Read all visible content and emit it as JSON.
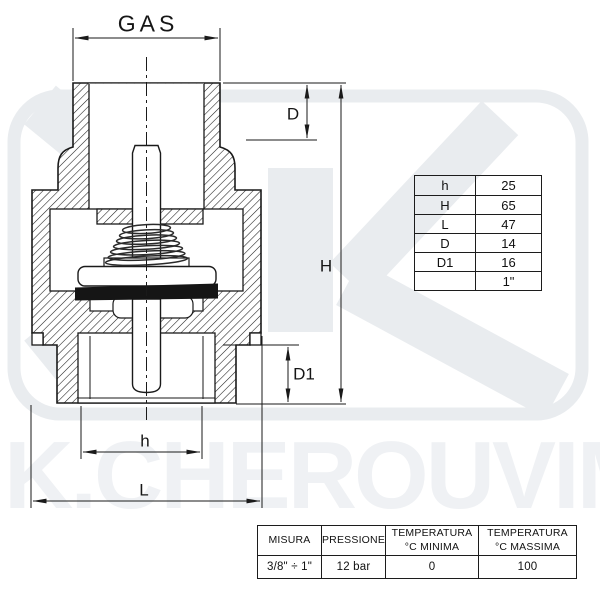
{
  "watermark": {
    "text": "K.CHEROUVIM"
  },
  "drawing": {
    "labels": {
      "gas": "GAS",
      "d": "D",
      "h_total": "H",
      "d1": "D1",
      "h_inner": "h",
      "l": "L"
    }
  },
  "dim_table": {
    "rows": [
      {
        "label": "h",
        "value": "25"
      },
      {
        "label": "H",
        "value": "65"
      },
      {
        "label": "L",
        "value": "47"
      },
      {
        "label": "D",
        "value": "14"
      },
      {
        "label": "D1",
        "value": "16"
      },
      {
        "label": "",
        "value": "1\""
      }
    ]
  },
  "spec_table": {
    "headers": [
      {
        "line1": "MISURA",
        "line2": ""
      },
      {
        "line1": "PRESSIONE",
        "line2": ""
      },
      {
        "line1": "TEMPERATURA",
        "line2": "°C MINIMA"
      },
      {
        "line1": "TEMPERATURA",
        "line2": "°C MASSIMA"
      }
    ],
    "values": [
      "3/8\" ÷ 1\"",
      "12 bar",
      "0",
      "100"
    ]
  },
  "colors": {
    "line": "#1a1a1a",
    "watermark_shape": "#e9ecef",
    "watermark_text": "#eff1f4"
  }
}
